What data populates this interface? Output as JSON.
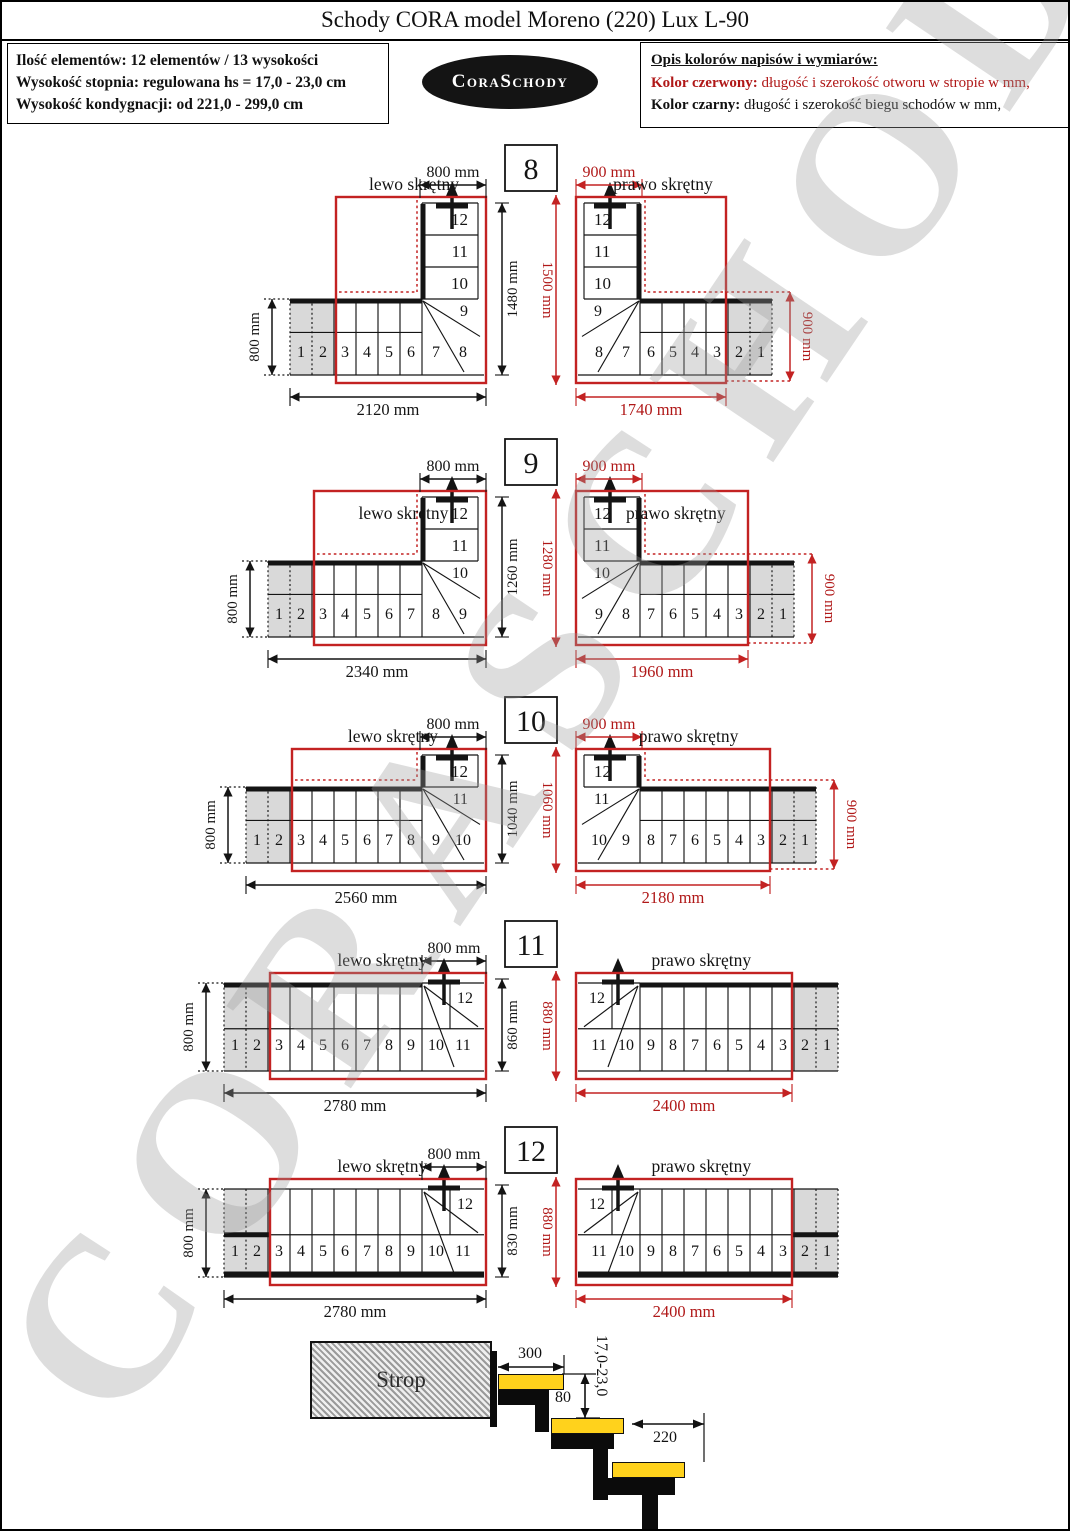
{
  "title": "Schody CORA model Moreno (220) Lux L-90",
  "info_box": {
    "lines": [
      "Ilość elementów: 12 elementów / 13 wysokości",
      "Wysokość stopnia: regulowana  hs = 17,0 - 23,0 cm",
      "Wysokość kondygnacji: od 221,0 - 299,0 cm"
    ]
  },
  "logo_text": "CoraSchody",
  "legend": {
    "heading": "Opis kolorów napisów i wymiarów:",
    "red_label": "Kolor czerwony:",
    "red_text": " długość i szerokość otworu w stropie w mm,",
    "black_label": "Kolor czarny:",
    "black_text": " długość i szerokość biegu schodów w mm,"
  },
  "watermark": "CORASCHODY",
  "colors": {
    "red_line": "#c32222",
    "red_text": "#b01818",
    "black_line": "#141414",
    "gray_fill": "#d9d9d9",
    "tread_yellow": "#ffd21c"
  },
  "diagrams": [
    {
      "number": "8",
      "center_dim_black": "1480 mm",
      "center_dim_red": "1500 mm",
      "left": {
        "label": "lewo skrętny",
        "top_dim": "800 mm",
        "side_dim": "800 mm",
        "bottom_dim": "2120 mm",
        "run_steps": [
          1,
          2,
          3,
          4,
          5,
          6,
          7,
          8
        ],
        "turn_steps": [
          12,
          11,
          10,
          9
        ]
      },
      "right": {
        "label": "prawo skrętny",
        "top_dim": "900 mm",
        "side_dim": "900 mm",
        "bottom_dim": "1740 mm",
        "run_steps": [
          8,
          7,
          6,
          5,
          4,
          3,
          2,
          1
        ],
        "turn_steps": [
          12,
          11,
          10,
          9
        ]
      }
    },
    {
      "number": "9",
      "center_dim_black": "1260 mm",
      "center_dim_red": "1280 mm",
      "left": {
        "label": "lewo skrętny",
        "top_dim": "800 mm",
        "side_dim": "800 mm",
        "bottom_dim": "2340 mm",
        "run_steps": [
          1,
          2,
          3,
          4,
          5,
          6,
          7,
          8,
          9
        ],
        "turn_steps": [
          12,
          11,
          10
        ]
      },
      "right": {
        "label": "prawo skrętny",
        "top_dim": "900 mm",
        "side_dim": "900 mm",
        "bottom_dim": "1960 mm",
        "run_steps": [
          9,
          8,
          7,
          6,
          5,
          4,
          3,
          2,
          1
        ],
        "turn_steps": [
          12,
          11,
          10
        ]
      }
    },
    {
      "number": "10",
      "center_dim_black": "1040 mm",
      "center_dim_red": "1060 mm",
      "left": {
        "label": "lewo skrętny",
        "top_dim": "800 mm",
        "side_dim": "800 mm",
        "bottom_dim": "2560 mm",
        "run_steps": [
          1,
          2,
          3,
          4,
          5,
          6,
          7,
          8,
          9,
          10
        ],
        "turn_steps": [
          12,
          11
        ]
      },
      "right": {
        "label": "prawo skrętny",
        "top_dim": "900 mm",
        "side_dim": "900 mm",
        "bottom_dim": "2180 mm",
        "run_steps": [
          10,
          9,
          8,
          7,
          6,
          5,
          4,
          3,
          2,
          1
        ],
        "turn_steps": [
          12,
          11
        ]
      }
    },
    {
      "number": "11",
      "center_dim_black": "860 mm",
      "center_dim_red": "880 mm",
      "left": {
        "label": "lewo skrętny",
        "top_dim": "800 mm",
        "side_dim": "800 mm",
        "bottom_dim": "2780 mm",
        "run_steps": [
          1,
          2,
          3,
          4,
          5,
          6,
          7,
          8,
          9,
          10,
          11
        ],
        "turn_steps": [
          12
        ]
      },
      "right": {
        "label": "prawo skrętny",
        "top_dim": null,
        "side_dim": null,
        "bottom_dim": "2400 mm",
        "run_steps": [
          11,
          10,
          9,
          8,
          7,
          6,
          5,
          4,
          3,
          2,
          1
        ],
        "turn_steps": [
          12
        ]
      }
    },
    {
      "number": "12",
      "center_dim_black": "830 mm",
      "center_dim_red": "880 mm",
      "bottom_wall": true,
      "left": {
        "label": "lewo skrętny",
        "top_dim": "800 mm",
        "side_dim": "800 mm",
        "bottom_dim": "2780 mm",
        "run_steps": [
          1,
          2,
          3,
          4,
          5,
          6,
          7,
          8,
          9,
          10,
          11
        ],
        "turn_steps": [
          12
        ]
      },
      "right": {
        "label": "prawo skrętny",
        "top_dim": null,
        "side_dim": null,
        "bottom_dim": "2400 mm",
        "run_steps": [
          11,
          10,
          9,
          8,
          7,
          6,
          5,
          4,
          3,
          2,
          1
        ],
        "turn_steps": [
          12
        ]
      }
    }
  ],
  "cross_section": {
    "strop_label": "Strop",
    "dim_depth": "300",
    "dim_overlap": "80",
    "dim_riser": "17,0-23,0",
    "dim_run": "220"
  }
}
